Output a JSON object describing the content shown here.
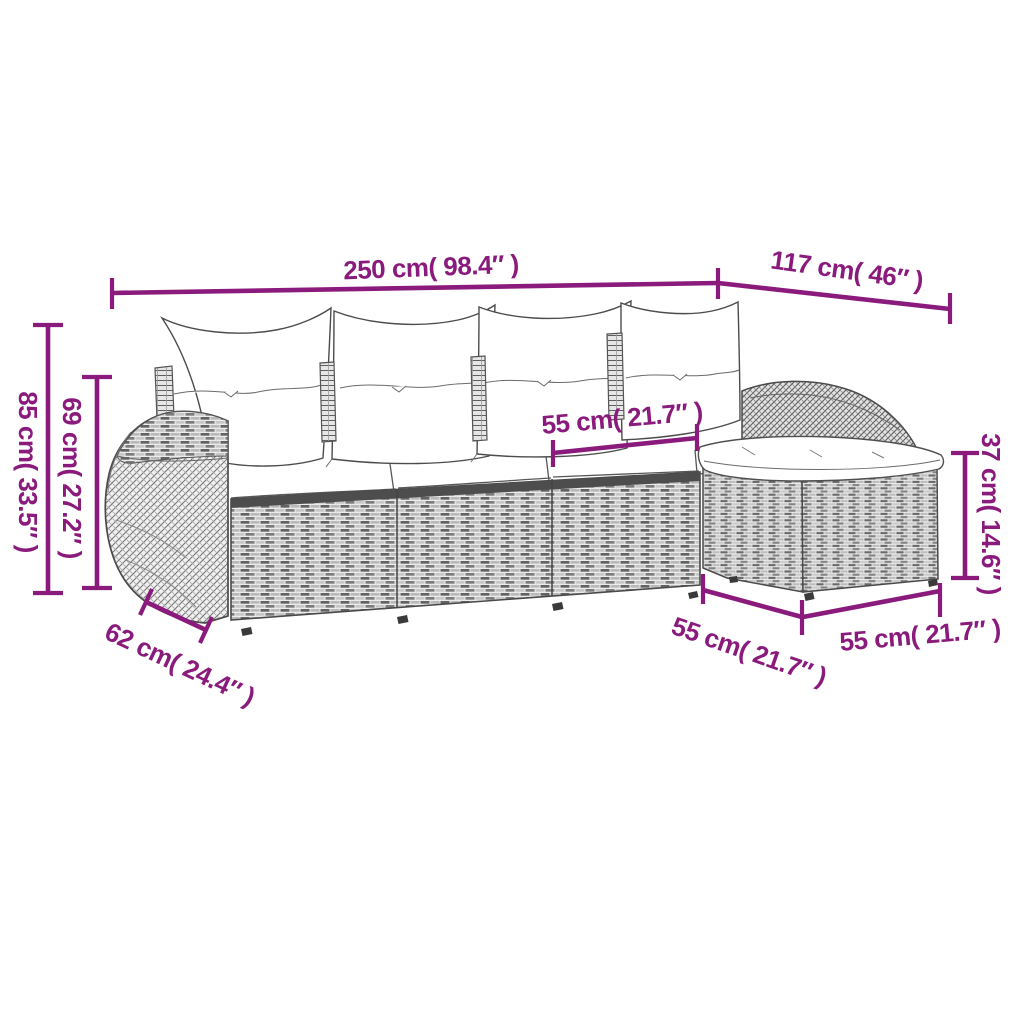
{
  "page": {
    "background": "#ffffff"
  },
  "colors": {
    "accent": "#8a1b7c",
    "line_art": "#4c4c4c",
    "cushion": "#ffffff"
  },
  "illustration": {
    "subject": "l-shaped-rattan-garden-sofa-set-with-ottoman-and-cushions"
  },
  "dims": {
    "top_main": "250 cm( 98.4″ )",
    "top_right": "117 cm( 46″ )",
    "left_outer": "85 cm( 33.5″ )",
    "left_inner": "69 cm( 27.2″ )",
    "seat_top": "55 cm( 21.7″ )",
    "right_side": "37 cm( 14.6″ )",
    "bottom_left": "62 cm( 24.4″ )",
    "bottom_mid": "55 cm( 21.7″ )",
    "bottom_right": "55 cm( 21.7″ )"
  }
}
